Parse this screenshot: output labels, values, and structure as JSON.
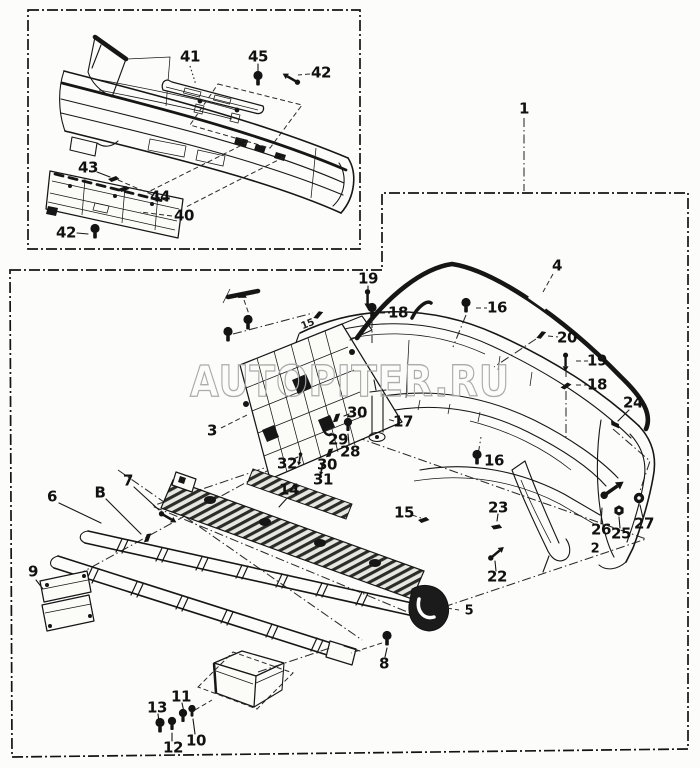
{
  "page": {
    "background": "#fcfcfb",
    "ink": "#161616"
  },
  "watermark": {
    "text": "AUTOPITER.RU",
    "color": "#ababab"
  },
  "inset_panel": {
    "callouts": [
      {
        "label": "41",
        "x": 190,
        "y": 57
      },
      {
        "label": "45",
        "x": 258,
        "y": 57
      },
      {
        "label": "42",
        "x": 321,
        "y": 73
      },
      {
        "label": "43",
        "x": 88,
        "y": 168
      },
      {
        "label": "44",
        "x": 160,
        "y": 197
      },
      {
        "label": "40",
        "x": 184,
        "y": 216
      },
      {
        "label": "42",
        "x": 66,
        "y": 233
      }
    ]
  },
  "main_panel": {
    "callouts": [
      {
        "label": "1",
        "x": 524,
        "y": 109
      },
      {
        "label": "4",
        "x": 557,
        "y": 266
      },
      {
        "label": "19",
        "x": 368,
        "y": 279
      },
      {
        "label": "18",
        "x": 398,
        "y": 313
      },
      {
        "label": "16",
        "x": 497,
        "y": 308
      },
      {
        "label": "20",
        "x": 567,
        "y": 338
      },
      {
        "label": "19",
        "x": 597,
        "y": 361
      },
      {
        "label": "18",
        "x": 597,
        "y": 385
      },
      {
        "label": "24",
        "x": 633,
        "y": 403
      },
      {
        "label": "3",
        "x": 212,
        "y": 431
      },
      {
        "label": "30",
        "x": 357,
        "y": 413
      },
      {
        "label": "17",
        "x": 403,
        "y": 422
      },
      {
        "label": "29",
        "x": 338,
        "y": 440
      },
      {
        "label": "28",
        "x": 350,
        "y": 452
      },
      {
        "label": "32",
        "x": 287,
        "y": 464
      },
      {
        "label": "30",
        "x": 327,
        "y": 465
      },
      {
        "label": "31",
        "x": 323,
        "y": 480
      },
      {
        "label": "16",
        "x": 494,
        "y": 461
      },
      {
        "label": "14",
        "x": 289,
        "y": 490
      },
      {
        "label": "15",
        "x": 404,
        "y": 513
      },
      {
        "label": "15",
        "x": 308,
        "y": 325,
        "size": "small"
      },
      {
        "label": "6",
        "x": 52,
        "y": 497
      },
      {
        "label": "B",
        "x": 100,
        "y": 493
      },
      {
        "label": "7",
        "x": 128,
        "y": 481
      },
      {
        "label": "23",
        "x": 498,
        "y": 508
      },
      {
        "label": "22",
        "x": 497,
        "y": 577
      },
      {
        "label": "26",
        "x": 601,
        "y": 530
      },
      {
        "label": "25",
        "x": 621,
        "y": 534
      },
      {
        "label": "27",
        "x": 644,
        "y": 524
      },
      {
        "label": "2",
        "x": 595,
        "y": 549,
        "size": "mid"
      },
      {
        "label": "9",
        "x": 33,
        "y": 572
      },
      {
        "label": "5",
        "x": 469,
        "y": 611,
        "size": "mid"
      },
      {
        "label": "8",
        "x": 384,
        "y": 664
      },
      {
        "label": "11",
        "x": 181,
        "y": 697
      },
      {
        "label": "13",
        "x": 157,
        "y": 708
      },
      {
        "label": "12",
        "x": 173,
        "y": 748
      },
      {
        "label": "10",
        "x": 196,
        "y": 741
      }
    ]
  },
  "fasteners": [
    {
      "type": "bolt",
      "x": 258,
      "y": 81,
      "rot": 0,
      "scale": 1
    },
    {
      "type": "screw",
      "x": 291,
      "y": 79,
      "rot": 210,
      "scale": 0.9
    },
    {
      "type": "clip",
      "x": 114,
      "y": 178,
      "rot": 15,
      "scale": 1
    },
    {
      "type": "clip",
      "x": 124,
      "y": 188,
      "rot": 15,
      "scale": 1
    },
    {
      "type": "bolt",
      "x": 95,
      "y": 234,
      "rot": 0,
      "scale": 1
    },
    {
      "type": "bolt",
      "x": 228,
      "y": 337,
      "rot": 0,
      "scale": 1
    },
    {
      "type": "bolt",
      "x": 248,
      "y": 325,
      "rot": 0,
      "scale": 1
    },
    {
      "type": "clip",
      "x": 318,
      "y": 314,
      "rot": -15,
      "scale": 1
    },
    {
      "type": "clip",
      "x": 242,
      "y": 295,
      "rot": 35,
      "scale": 1
    },
    {
      "type": "screw",
      "x": 368,
      "y": 299,
      "rot": 90,
      "scale": 0.9
    },
    {
      "type": "bolt",
      "x": 372,
      "y": 313,
      "rot": 0,
      "scale": 1
    },
    {
      "type": "bolt",
      "x": 466,
      "y": 308,
      "rot": 0,
      "scale": 1
    },
    {
      "type": "clip",
      "x": 541,
      "y": 334,
      "rot": -15,
      "scale": 1
    },
    {
      "type": "screw",
      "x": 566,
      "y": 362,
      "rot": 90,
      "scale": 0.85
    },
    {
      "type": "clip",
      "x": 566,
      "y": 385,
      "rot": 0,
      "scale": 1
    },
    {
      "type": "clip",
      "x": 616,
      "y": 424,
      "rot": 60,
      "scale": 1
    },
    {
      "type": "bolt",
      "x": 477,
      "y": 460,
      "rot": 0,
      "scale": 1
    },
    {
      "type": "clip",
      "x": 336,
      "y": 417,
      "rot": -35,
      "scale": 1
    },
    {
      "type": "cclip",
      "x": 327,
      "y": 431,
      "rot": 0,
      "scale": 1
    },
    {
      "type": "bolt",
      "x": 348,
      "y": 427,
      "rot": 0,
      "scale": 0.9
    },
    {
      "type": "clip",
      "x": 329,
      "y": 452,
      "rot": -35,
      "scale": 1
    },
    {
      "type": "screw",
      "x": 300,
      "y": 459,
      "rot": 100,
      "scale": 0.6
    },
    {
      "type": "screw",
      "x": 322,
      "y": 469,
      "rot": 100,
      "scale": 0.6
    },
    {
      "type": "clip",
      "x": 424,
      "y": 519,
      "rot": 15,
      "scale": 1
    },
    {
      "type": "clip",
      "x": 497,
      "y": 526,
      "rot": 25,
      "scale": 1
    },
    {
      "type": "screw",
      "x": 496,
      "y": 553,
      "rot": -40,
      "scale": 0.9
    },
    {
      "type": "screw",
      "x": 612,
      "y": 489,
      "rot": -35,
      "scale": 1.25
    },
    {
      "type": "nut",
      "x": 619,
      "y": 511,
      "rot": 0,
      "scale": 1
    },
    {
      "type": "ring",
      "x": 639,
      "y": 499,
      "rot": 0,
      "scale": 1
    },
    {
      "type": "bolt",
      "x": 387,
      "y": 641,
      "rot": 0,
      "scale": 1
    },
    {
      "type": "bolt",
      "x": 160,
      "y": 728,
      "rot": 0,
      "scale": 1
    },
    {
      "type": "bolt",
      "x": 172,
      "y": 726,
      "rot": 0,
      "scale": 0.9
    },
    {
      "type": "bolt",
      "x": 183,
      "y": 718,
      "rot": 0,
      "scale": 0.9
    },
    {
      "type": "bolt",
      "x": 192,
      "y": 713,
      "rot": 0,
      "scale": 0.8
    },
    {
      "type": "clip",
      "x": 147,
      "y": 537,
      "rot": -35,
      "scale": 1
    },
    {
      "type": "screw",
      "x": 168,
      "y": 517,
      "rot": 30,
      "scale": 0.9
    }
  ]
}
